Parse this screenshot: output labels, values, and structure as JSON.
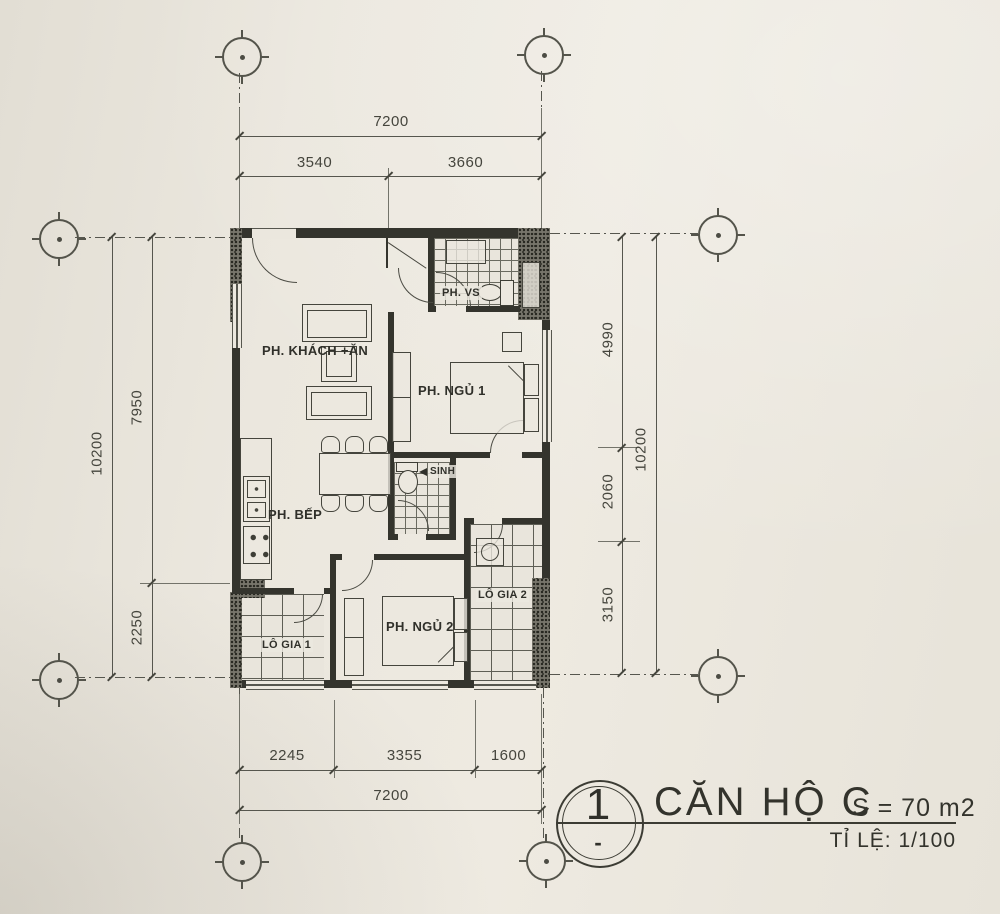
{
  "sheet": {
    "paper_color": "#eae6dd",
    "ink_color": "#3c3c34",
    "wall_color": "#34342d"
  },
  "title_block": {
    "detail_number": "1",
    "detail_mark": "-",
    "title": "CĂN HỘ C",
    "area": "S = 70 m2",
    "scale": "TỈ LỆ: 1/100"
  },
  "rooms": {
    "living": "PH. KHÁCH +ĂN",
    "kitchen": "PH. BẾP",
    "bedroom1": "PH. NGỦ 1",
    "bedroom2": "PH. NGỦ 2",
    "bathroom1": "PH. VS",
    "bathroom2": "SINH",
    "loggia1": "LÔ GIA 1",
    "loggia2": "LÔ GIA 2"
  },
  "dimensions": {
    "top": {
      "overall": "7200",
      "seg1": "3540",
      "seg2": "3660"
    },
    "bottom": {
      "overall": "7200",
      "seg1": "2245",
      "seg2": "3355",
      "seg3": "1600"
    },
    "left": {
      "overall": "10200",
      "seg1": "7950",
      "seg2": "2250"
    },
    "right": {
      "overall": "10200",
      "seg1": "4990",
      "seg2": "2060",
      "seg3": "3150"
    }
  }
}
